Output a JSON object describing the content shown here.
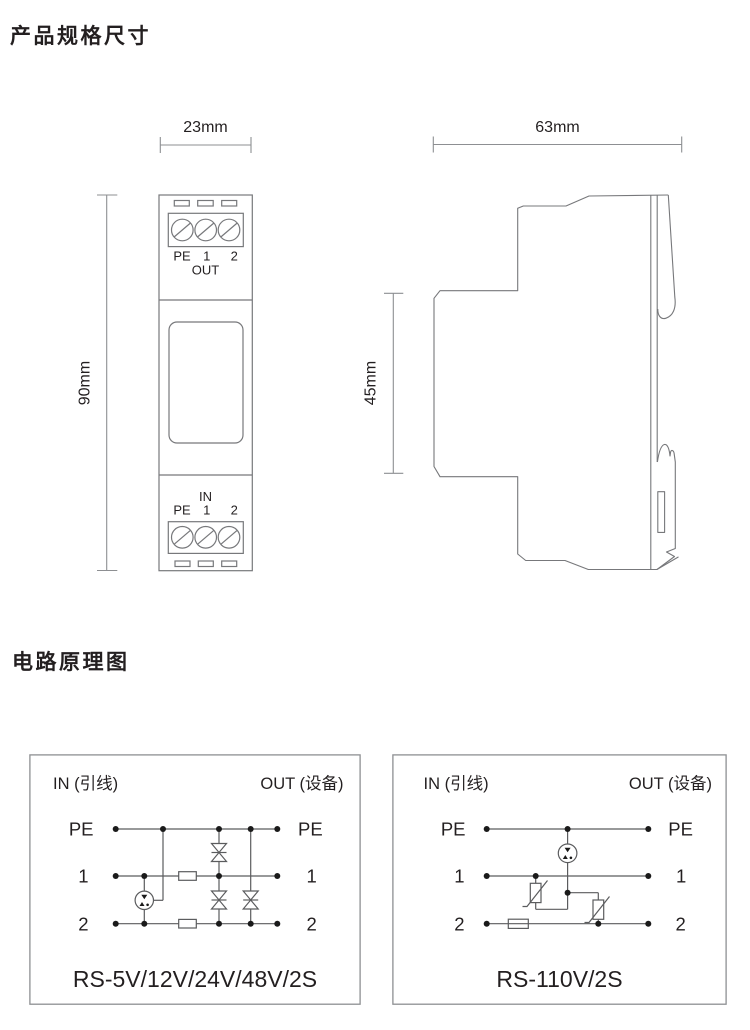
{
  "page": {
    "background": "#ffffff"
  },
  "spec_section": {
    "title": "产品规格尺寸"
  },
  "circuit_section": {
    "title": "电路原理图"
  },
  "front_view": {
    "width_dim": "23mm",
    "height_dim": "90mm",
    "out_block": {
      "pe": "PE",
      "t1": "1",
      "t2": "2",
      "port": "OUT"
    },
    "in_block": {
      "port": "IN",
      "pe": "PE",
      "t1": "1",
      "t2": "2"
    }
  },
  "side_view": {
    "width_dim": "63mm",
    "height_dim": "45mm"
  },
  "circuits": [
    {
      "in_label": "IN (引线)",
      "out_label": "OUT (设备)",
      "left": {
        "pe": "PE",
        "t1": "1",
        "t2": "2"
      },
      "right": {
        "pe": "PE",
        "t1": "1",
        "t2": "2"
      },
      "model": "RS-5V/12V/24V/48V/2S",
      "components": [
        "gas-discharge-tube-3pole",
        "series-resistor-line1",
        "series-resistor-line2",
        "tvs-diode-pe-line1",
        "tvs-diode-line1-line2",
        "tvs-diode-pe-line2"
      ]
    },
    {
      "in_label": "IN (引线)",
      "out_label": "OUT (设备)",
      "left": {
        "pe": "PE",
        "t1": "1",
        "t2": "2"
      },
      "right": {
        "pe": "PE",
        "t1": "1",
        "t2": "2"
      },
      "model": "RS-110V/2S",
      "components": [
        "gas-discharge-tube-to-pe",
        "varistor-line1",
        "varistor-line2",
        "fuse-line2"
      ]
    }
  ],
  "colors": {
    "device_line": "#77787b",
    "dim_line": "#8d8f92",
    "circuit_line": "#5b5c5e",
    "box_border": "#8d8f92",
    "text": "#231f20",
    "dot": "#1a1a1a"
  }
}
